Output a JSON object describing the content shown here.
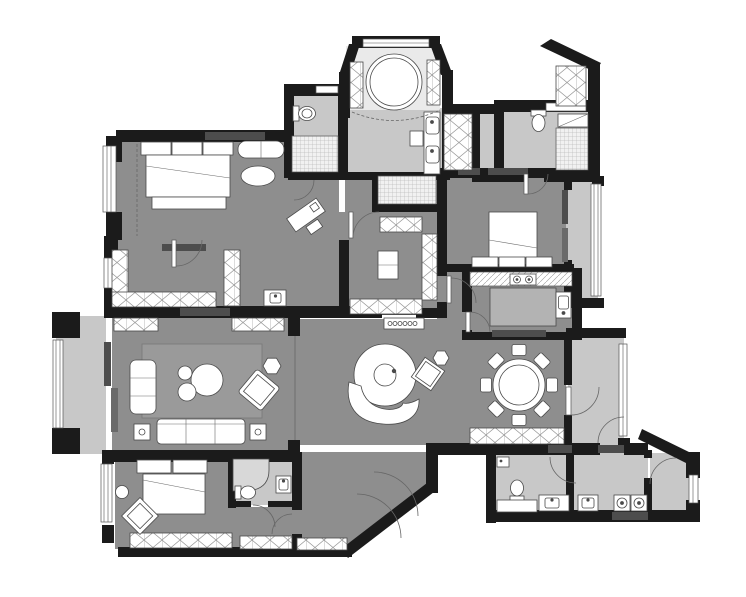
{
  "meta": {
    "title": "apartment floor plan"
  },
  "palette": {
    "background": "#ffffff",
    "wall": "#1b1b1b",
    "wall_accent": "#4d4d4d",
    "wall_accent_light": "#6a6a6a",
    "floor_dark": "#8e8e8e",
    "floor_light": "#c8c8c8",
    "floor_pale": "#eaeaea",
    "furniture_fill": "#ffffff",
    "furniture_stroke": "#4a4a4a",
    "island_fill": "#b3b3b3",
    "rug_fill": "#9a9a9a",
    "shower_glass": "#d8d8d8"
  },
  "rooms": [
    {
      "name": "master-bedroom"
    },
    {
      "name": "master-toilet-room"
    },
    {
      "name": "master-shower"
    },
    {
      "name": "bathtub-bay"
    },
    {
      "name": "vanity-room"
    },
    {
      "name": "walk-in-closet"
    },
    {
      "name": "dressing-corridor"
    },
    {
      "name": "second-bedroom"
    },
    {
      "name": "guest-bathroom"
    },
    {
      "name": "bedroom-balcony"
    },
    {
      "name": "kitchen"
    },
    {
      "name": "dining-area"
    },
    {
      "name": "central-hall"
    },
    {
      "name": "living-room"
    },
    {
      "name": "west-balcony"
    },
    {
      "name": "third-bedroom"
    },
    {
      "name": "ensuite-bathroom"
    },
    {
      "name": "entry-foyer"
    },
    {
      "name": "east-corridor"
    },
    {
      "name": "service-bathroom"
    },
    {
      "name": "laundry-room"
    },
    {
      "name": "service-balcony"
    }
  ],
  "furniture": [
    {
      "name": "double-bed-master"
    },
    {
      "name": "window-bench"
    },
    {
      "name": "oval-rug"
    },
    {
      "name": "writing-desk"
    },
    {
      "name": "round-bathtub"
    },
    {
      "name": "double-vanity"
    },
    {
      "name": "toilet"
    },
    {
      "name": "walk-in-shower"
    },
    {
      "name": "closet-island"
    },
    {
      "name": "double-bed-second"
    },
    {
      "name": "kitchen-island"
    },
    {
      "name": "cooktop"
    },
    {
      "name": "kitchen-sink"
    },
    {
      "name": "round-dining-table"
    },
    {
      "name": "dining-chair"
    },
    {
      "name": "sideboard"
    },
    {
      "name": "round-lounge-chair"
    },
    {
      "name": "curved-bench"
    },
    {
      "name": "accent-chair"
    },
    {
      "name": "sofa"
    },
    {
      "name": "chaise"
    },
    {
      "name": "coffee-table"
    },
    {
      "name": "side-table"
    },
    {
      "name": "area-rug"
    },
    {
      "name": "double-bed-third"
    },
    {
      "name": "lounge-diamond-chair"
    },
    {
      "name": "washer"
    },
    {
      "name": "dryer"
    },
    {
      "name": "laundry-sink"
    },
    {
      "name": "shoe-cabinet"
    }
  ]
}
